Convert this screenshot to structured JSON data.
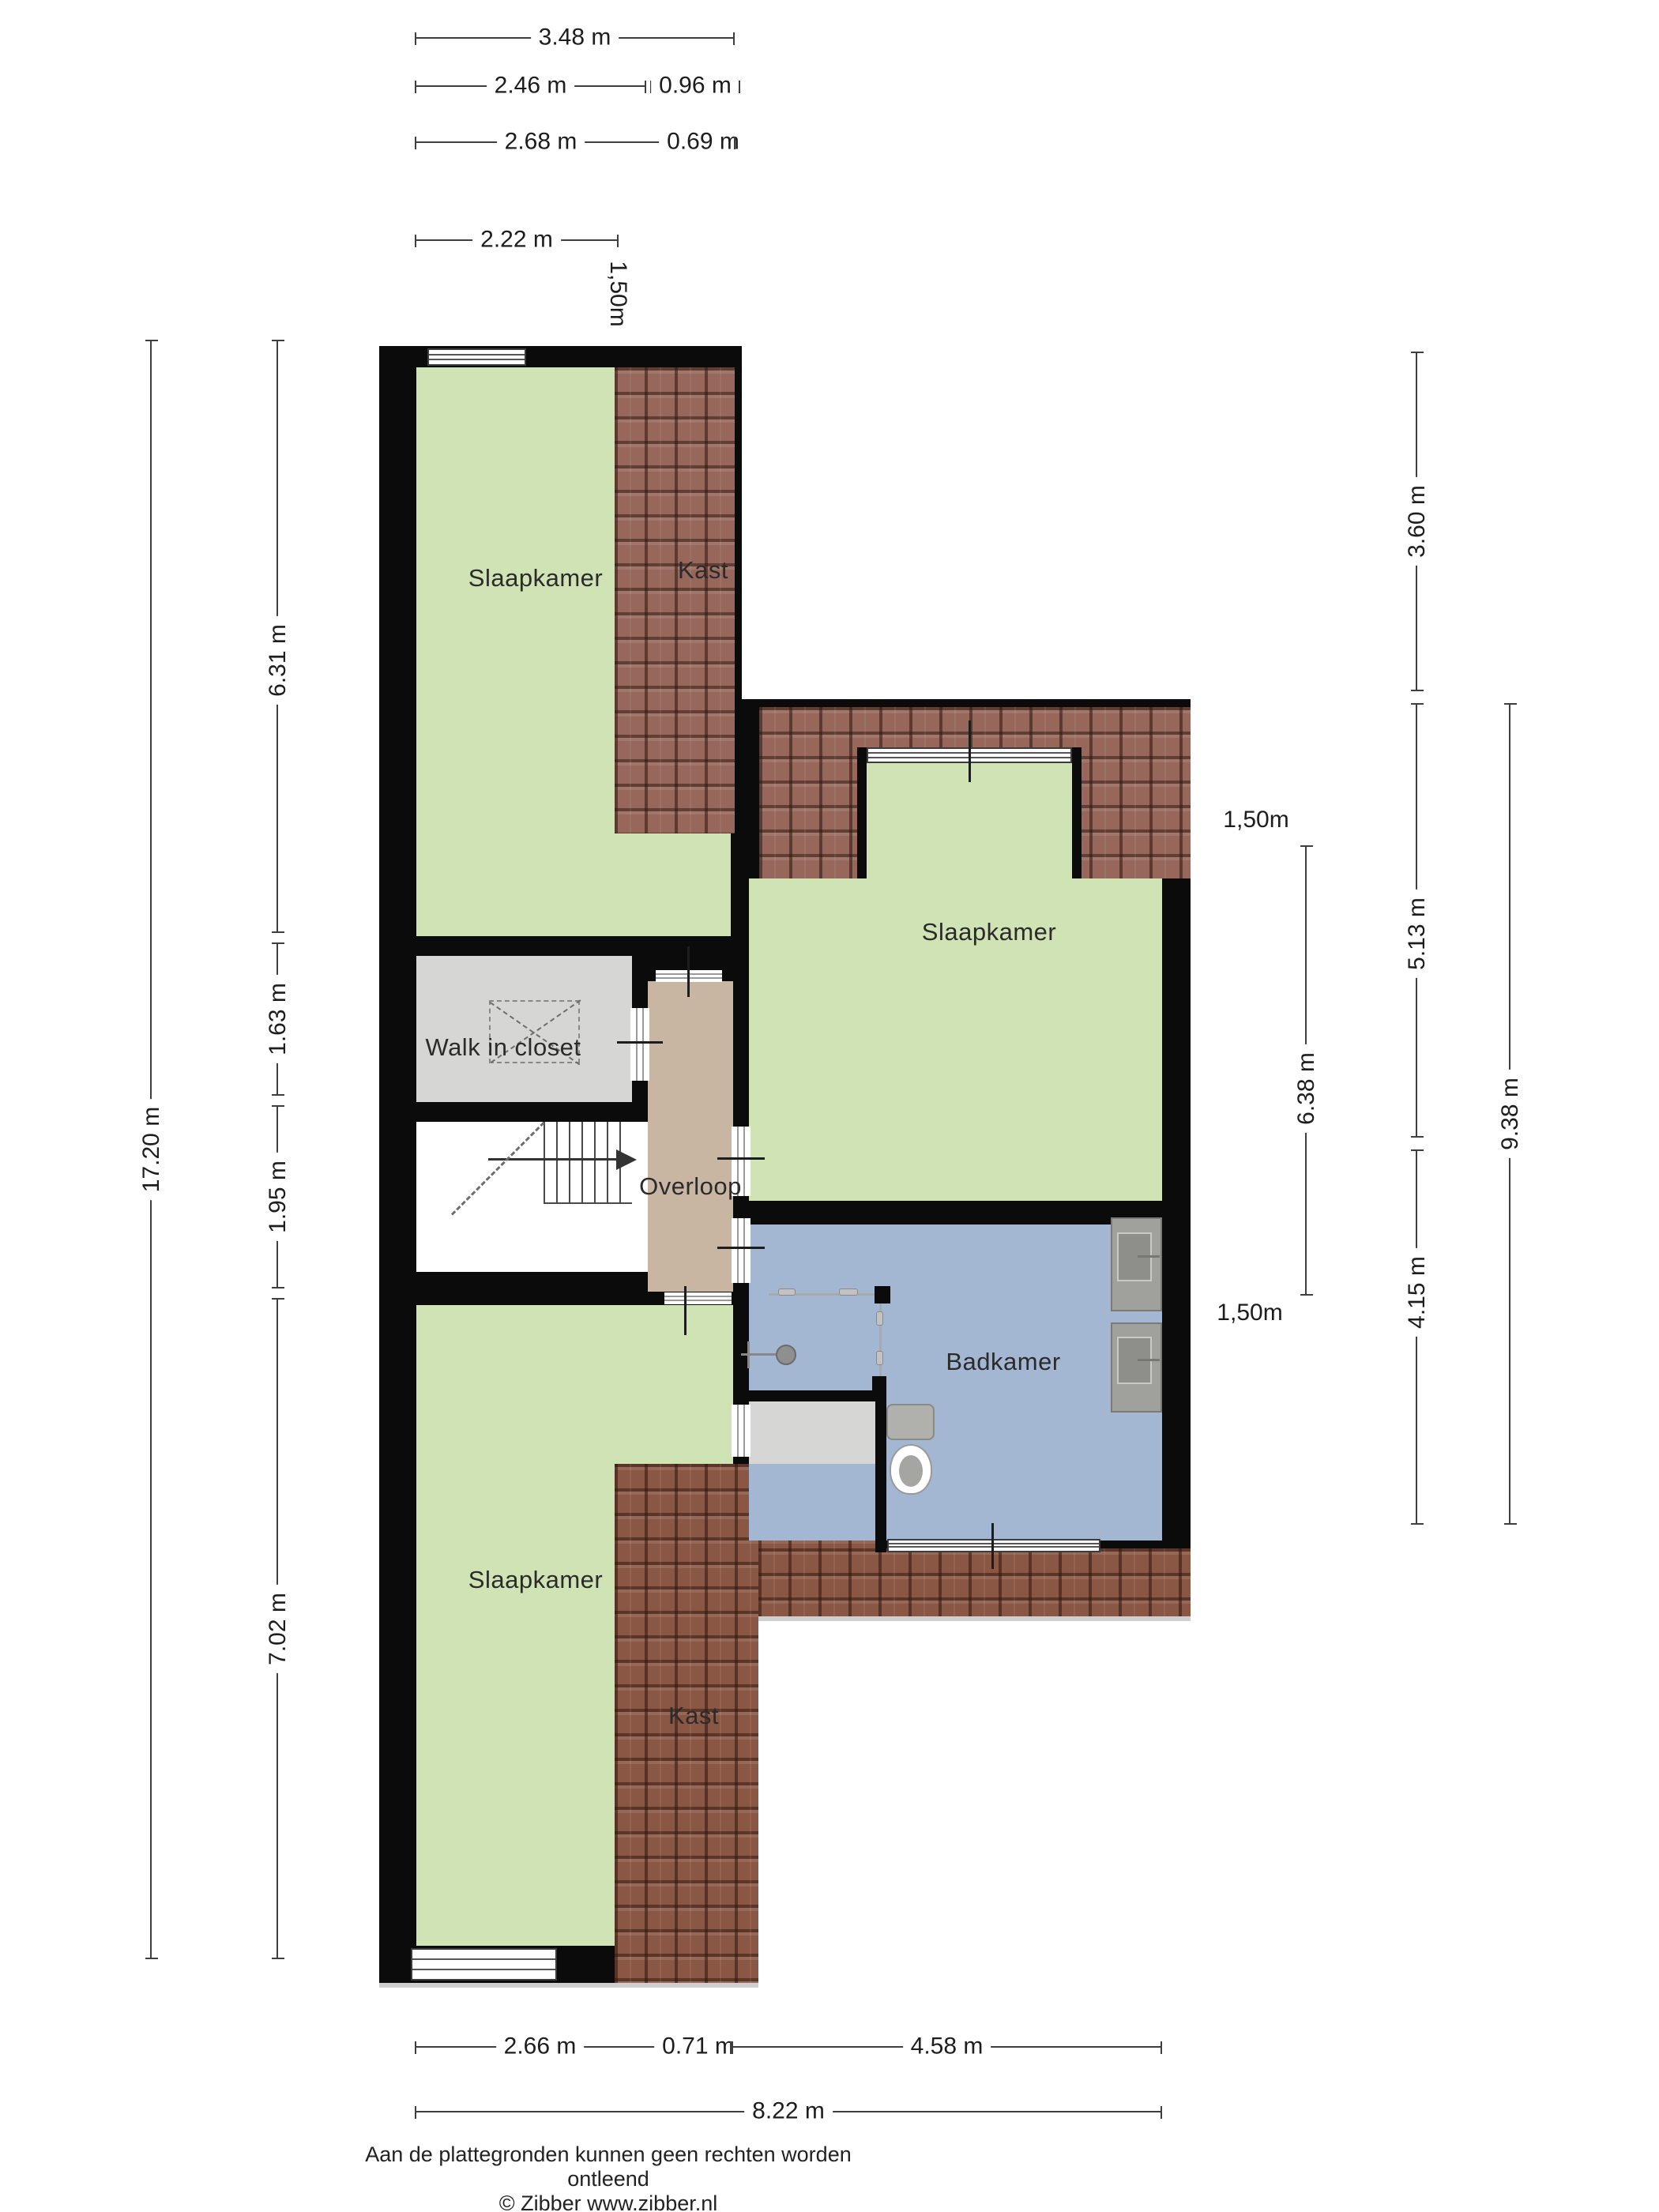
{
  "rooms": {
    "bedroom_tl": "Slaapkamer",
    "closet_top": "Kast",
    "bedroom_right": "Slaapkamer",
    "walk_in_closet": "Walk in closet",
    "landing": "Overloop",
    "bathroom": "Badkamer",
    "bedroom_bl": "Slaapkamer",
    "closet_bottom": "Kast"
  },
  "dimensions": {
    "top": [
      "3.48 m",
      "2.46 m",
      "0.96 m",
      "2.68 m",
      "0.69 m",
      "2.22 m"
    ],
    "top_height_label": "1,50m",
    "left": [
      "17.20 m",
      "6.31 m",
      "1.63 m",
      "1.95 m",
      "7.02 m"
    ],
    "right": [
      "3.60 m",
      "5.13 m",
      "4.15 m",
      "9.38 m",
      "6.38 m"
    ],
    "right_height_top": "1,50m",
    "right_height_bottom": "1,50m",
    "bottom": [
      "2.66 m",
      "0.71 m",
      "4.58 m",
      "8.22 m"
    ]
  },
  "footer": {
    "line1": "Aan de plattegronden kunnen geen rechten worden ontleend",
    "line2": "© Zibber www.zibber.nl"
  },
  "colors": {
    "wall": "#0b0b0b",
    "bedroom_green": "#cfe3b4",
    "bathroom_blue": "#a3b7d3",
    "landing_tan": "#c9b6a2",
    "closet_gray": "#d6d6d4",
    "roof_tile": "#96675a",
    "roof_tile_dark": "#8a5744",
    "dim_line": "#3f3f3f"
  }
}
